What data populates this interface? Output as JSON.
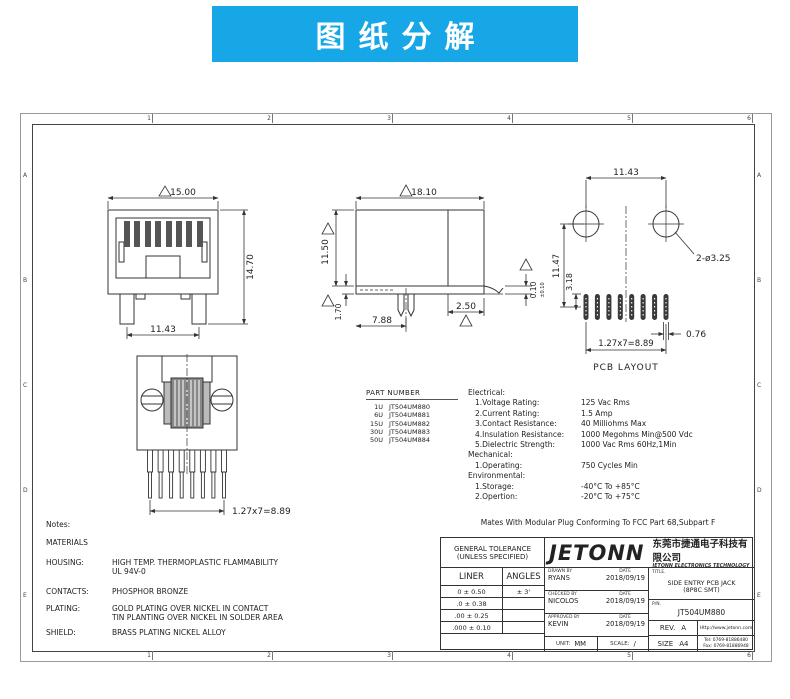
{
  "colors": {
    "banner_bg": "#17a7e7",
    "line": "#333333"
  },
  "banner": {
    "text": "图纸分解"
  },
  "grid": {
    "cols": [
      "1",
      "2",
      "3",
      "4",
      "5",
      "6"
    ],
    "rows": [
      "A",
      "B",
      "C",
      "D",
      "E"
    ]
  },
  "views": {
    "front": {
      "dim_width": "15.00",
      "dim_height": "14.70",
      "dim_feet": "11.43"
    },
    "side": {
      "dim_width": "18.10",
      "dim_height": "11.50",
      "dim_standoff": "1.70",
      "dim_peg": "7.88",
      "dim_tail": "2.50",
      "dim_coplanarity": "0.10",
      "dim_coplanarity_tol": "±0.10"
    },
    "pcb": {
      "dim_hole_span": "11.43",
      "dim_holes": "2-ø3.25",
      "dim_height": "11.47",
      "dim_pad": "3.18",
      "dim_pad_width": "0.76",
      "dim_pitch": "1.27x7=8.89",
      "caption": "PCB LAYOUT"
    },
    "bottom": {
      "dim_pitch": "1.27x7=8.89"
    }
  },
  "part_table": {
    "title": "PART NUMBER",
    "rows": [
      {
        "code": "1U",
        "pn": "JT504UM880"
      },
      {
        "code": "6U",
        "pn": "JT504UM881"
      },
      {
        "code": "15U",
        "pn": "JT504UM882"
      },
      {
        "code": "30U",
        "pn": "JT504UM883"
      },
      {
        "code": "50U",
        "pn": "JT504UM884"
      }
    ]
  },
  "specs": {
    "electrical_title": "Electrical:",
    "electrical": [
      {
        "label": "1.Voltage Rating:",
        "value": "125 Vac Rms"
      },
      {
        "label": "2.Current Rating:",
        "value": "1.5 Amp"
      },
      {
        "label": "3.Contact Resistance:",
        "value": "40 Milliohms Max"
      },
      {
        "label": "4.Insulation Resistance:",
        "value": "1000 Megohms Min@500 Vdc"
      },
      {
        "label": "5.Dielectric Strength:",
        "value": "1000 Vac Rms 60Hz,1Min"
      }
    ],
    "mechanical_title": "Mechanical:",
    "mechanical": [
      {
        "label": "1.Operating:",
        "value": "750 Cycles Min"
      }
    ],
    "environmental_title": "Environmental:",
    "environmental": [
      {
        "label": "1.Storage:",
        "value": "-40°C To +85°C"
      },
      {
        "label": "2.Opertion:",
        "value": "-20°C To +75°C"
      }
    ],
    "footnote": "Mates With Modular Plug Conforming To FCC Part 68,Subpart F"
  },
  "notes": {
    "title": "Notes:",
    "materials_title": "MATERIALS",
    "items": [
      {
        "label": "HOUSING:",
        "lines": [
          "HIGH TEMP. THERMOPLASTIC FLAMMABILITY",
          "UL 94V-0"
        ]
      },
      {
        "label": "CONTACTS:",
        "lines": [
          "PHOSPHOR BRONZE"
        ]
      },
      {
        "label": "PLATING:",
        "lines": [
          "GOLD PLATING OVER NICKEL IN CONTACT",
          "TIN PLANTING OVER NICKEL IN SOLDER AREA"
        ]
      },
      {
        "label": "SHIELD:",
        "lines": [
          "BRASS PLATING NICKEL ALLOY"
        ]
      }
    ]
  },
  "title_block": {
    "general_tolerance_line1": "GENERAL TOLERANCE",
    "general_tolerance_line2": "(UNLESS SPECIFIED)",
    "liner_header": "LINER",
    "angles_header": "ANGLES",
    "tol_rows": [
      {
        "liner": "0 ± 0.50",
        "angle": "± 3'"
      },
      {
        "liner": ".0 ± 0.38",
        "angle": ""
      },
      {
        "liner": ".00 ± 0.25",
        "angle": ""
      },
      {
        "liner": ".000 ± 0.10",
        "angle": ""
      }
    ],
    "date_label": "DATE",
    "drawn_by_label": "DRAWN BY",
    "drawn_by": "RYANS",
    "drawn_date": "2018/09/19",
    "checked_by_label": "CHECKED BY",
    "checked_by": "NICOLOS",
    "checked_date": "2018/09/19",
    "approved_by_label": "APPROVED BY",
    "approved_by": "KEVIN",
    "approved_date": "2018/09/19",
    "unit_label": "UNIT:",
    "unit_value": "MM",
    "scale_label": "SCALE:",
    "scale_value": "/",
    "logo_text": "JETONN",
    "company_cn": "东莞市捷通电子科技有限公司",
    "company_en": "JETONN ELECTRONICS TECHNOLOGY",
    "title_label": "TITLE.",
    "title_line1": "SIDE ENTRY PCB JACK",
    "title_line2": "(8P8C SMT)",
    "pn_label": "P/N.",
    "pn_value": "JT504UM880",
    "rev_label": "REV.",
    "rev_value": "A",
    "size_label": "SIZE",
    "size_value": "A4",
    "website": "Http://www.jetonn.com",
    "tel": "Tel: 0769-81886480",
    "fax": "Fax: 0769-81886948"
  }
}
